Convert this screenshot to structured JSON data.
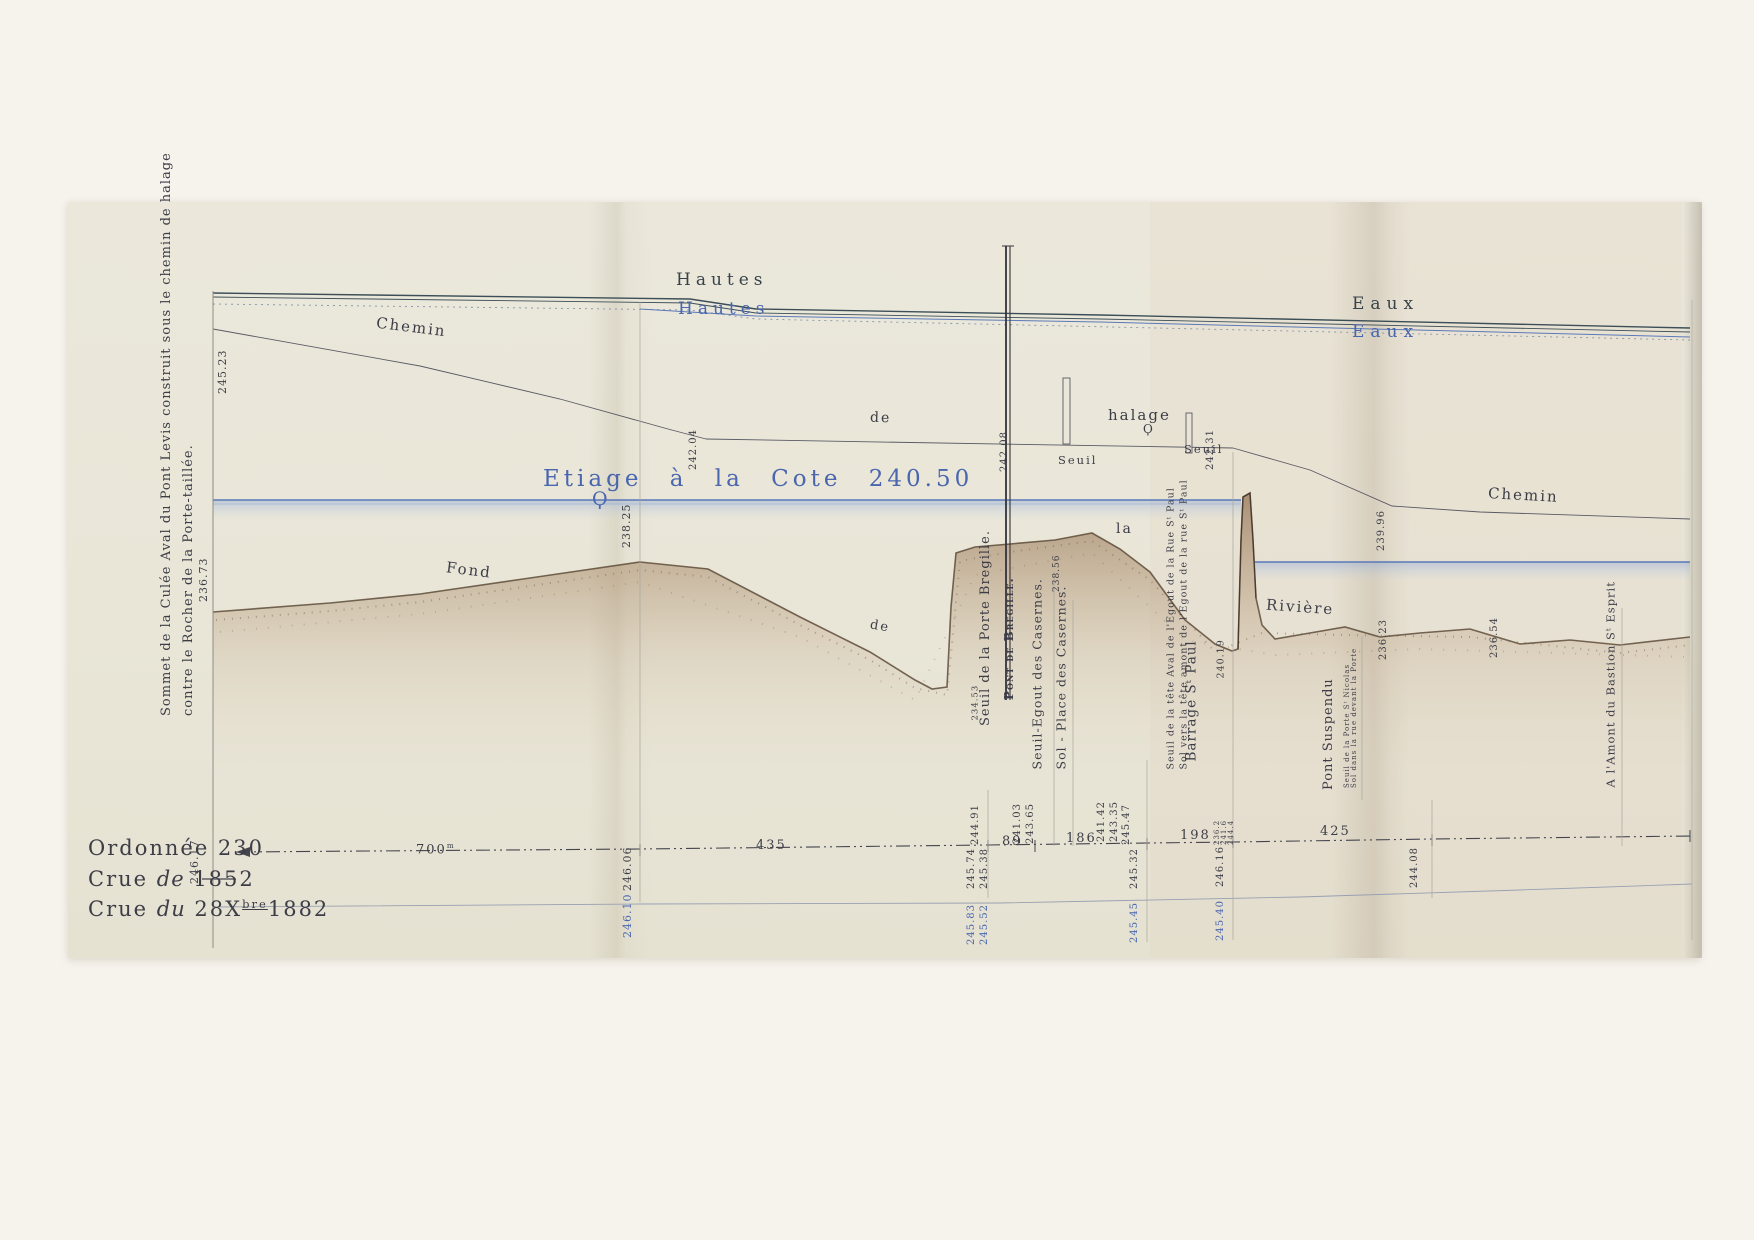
{
  "colors": {
    "ink": "#3d3d47",
    "blue_ink": "#4966ae",
    "water_line": "#5b79b8",
    "bed": "#8f6f50"
  },
  "flood": {
    "hautes_dark": "Hautes",
    "hautes_blue": "Hautes",
    "eaux_dark": "Eaux",
    "eaux_blue": "Eaux"
  },
  "etiage": {
    "label": "Etiage  à la  Cote 240.50",
    "flourish": "Ϙ"
  },
  "path": {
    "chemin_left": "Chemin",
    "de_mid": "de",
    "halage": "halage",
    "halage_flourish": "Ϙ",
    "seuil_post_left": "Seuil",
    "seuil_post_right": "Seuil",
    "chemin_right": "Chemin"
  },
  "bed_words": {
    "fond": "Fond",
    "de": "de",
    "la": "la",
    "riviere": "Rivière"
  },
  "side_note": {
    "line1": "Sommet de la Culée Aval du Pont Levis construit sous le chemin de halage",
    "line2": "contre  le Rocher de la Porte-taillée."
  },
  "margin": {
    "ordonnee": "Ordonnée 230",
    "crue1852": {
      "word": "Crue",
      "article": "de",
      "year": "1852"
    },
    "crue1882": {
      "word": "Crue",
      "article": "du",
      "day": "28",
      "month": "X",
      "month_sup": "bre",
      "year": "1882"
    }
  },
  "structures": {
    "bregille": {
      "seuil": "Seuil de la Porte Bregille.",
      "name": "Pont de Bregille.",
      "seuil_value": "234.53"
    },
    "casernes": {
      "seuil": "Seuil-Egout des Casernes.",
      "seuil_value": "238.56",
      "sol": "Sol - Place des Casernes."
    },
    "stpaul": {
      "seuil": "Seuil de la tête Aval de l'Egout de la Rue Sᵗ Paul",
      "sol": "Sol vers la tête amont de l'Egout de la rue Sᵗ Paul",
      "barrage": "Barrage Sᵗ Paul",
      "value": "240.19"
    },
    "suspendu": {
      "name": "Pont Suspendu",
      "seuil": "Seuil de la Porte Sᵗ Nicolas",
      "sol": "Sol dans la rue devant la Porte",
      "value": "236.23"
    },
    "bastion": {
      "name": "A l'Amont du Bastion Sᵗ Esprit"
    }
  },
  "elevations": {
    "chemin_start": "245.23",
    "chemin_junction": "242.04",
    "chemin_bregille": "242.08",
    "chemin_seuil_right": "242.31",
    "chemin_suspendu": "239.96",
    "bed_left": "236.73",
    "bed_peak": "238.25",
    "bed_suspendu": "236.23",
    "bed_right": "236.54",
    "col_left_1852": "246.17",
    "fold_1852": "246.06",
    "fold_1882": "246.10",
    "bregille_above": "244.91",
    "bregille_1852_a": "245.74",
    "bregille_1852_b": "245.38",
    "bregille_1882_a": "245.83",
    "bregille_1882_b": "245.52",
    "casernes_above_a": "241.03",
    "casernes_above_b": "243.65",
    "stpaul_above_a": "241.42",
    "stpaul_above_b": "243.35",
    "stpaul_above_c": "245.47",
    "stpaul_1852": "245.32",
    "stpaul_1882": "245.45",
    "barrage_stack": [
      "236.2",
      "241.6",
      "244.4"
    ],
    "barrage_1852": "246.16",
    "barrage_1882": "245.40",
    "bastion_1852": "244.08"
  },
  "distances": {
    "d700": "700",
    "d700_unit": "m",
    "d435": "435",
    "d89": "89",
    "d186": "186",
    "d198": "198",
    "d425": "425"
  }
}
